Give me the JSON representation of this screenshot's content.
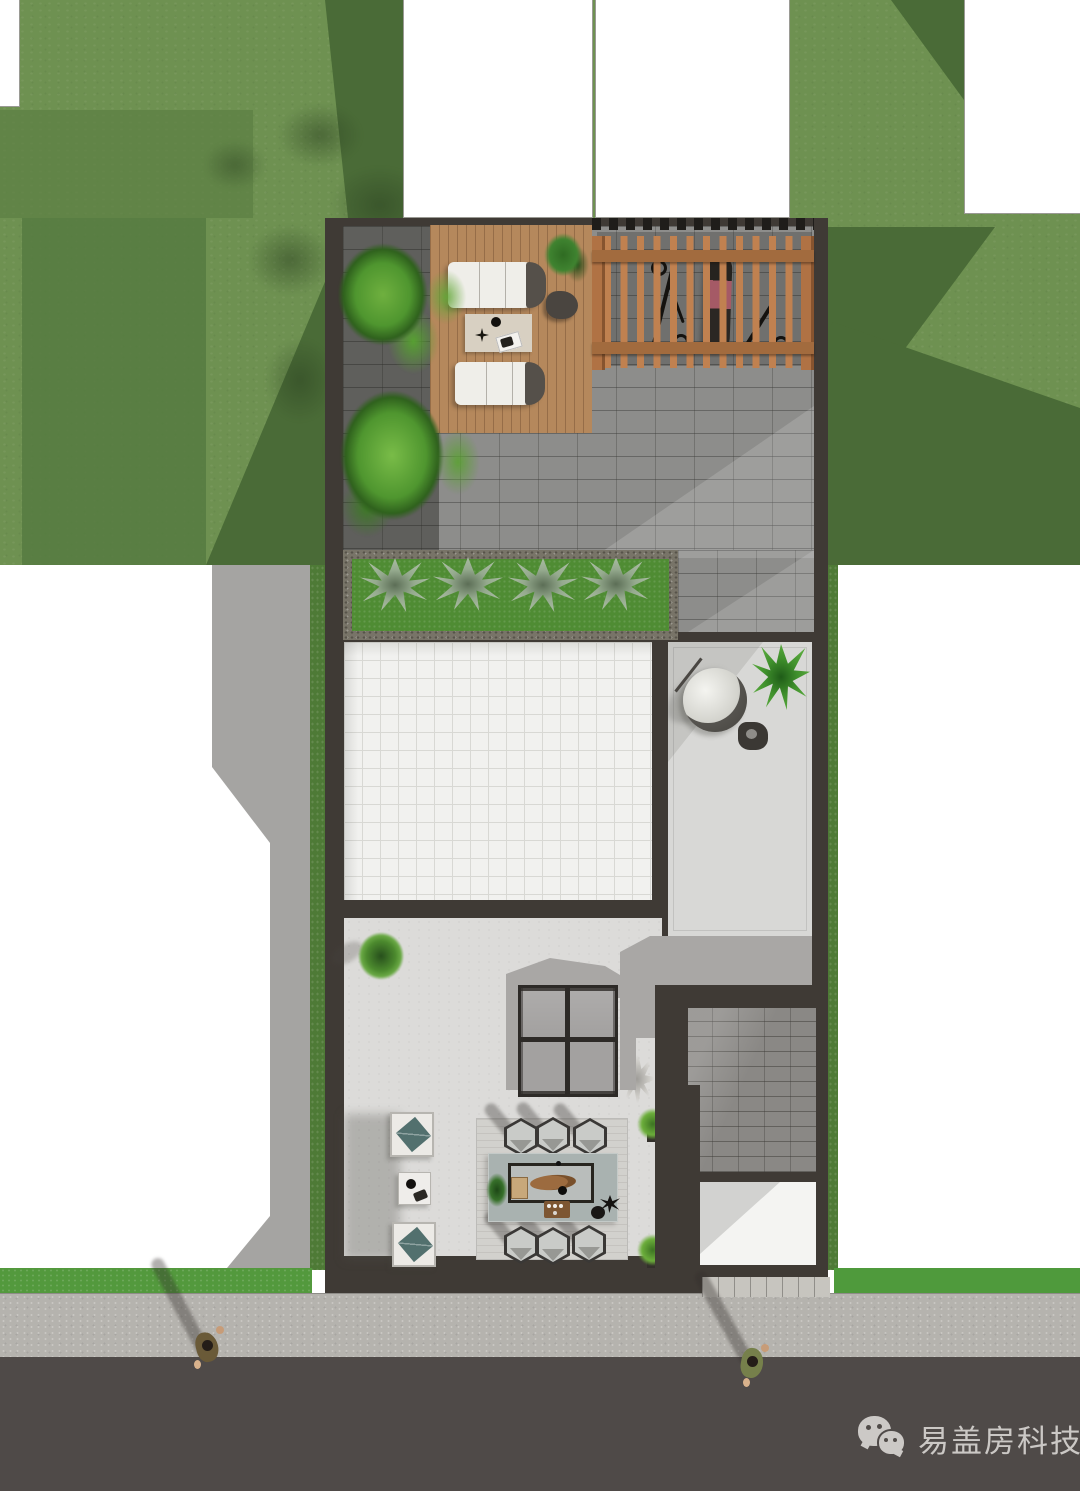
{
  "watermark": {
    "icon": "wechat-icon",
    "text": "易盖房科技"
  },
  "palette": {
    "lawn_light": "#6e9151",
    "lawn_medium": "#5d8044",
    "lawn_shadow": "#4a6b37",
    "lawn_bright_strip": "#53993d",
    "hedge_green": "#4e7a36",
    "wall_dark": "#3f3a35",
    "paving_gray": "#8d8d8b",
    "deck_wood": "#b5885c",
    "pergola_wood": "#c08150",
    "white_grid_tile": "#f1f1ef",
    "terrace_floor": "#d8d8d6",
    "courtyard_floor": "#dcdbd9",
    "shadow_gray": "#a9a7a5",
    "shingle_gray": "#8a8885",
    "sidewalk": "#b5b3ae",
    "road_asphalt": "#4f4a48",
    "neighbor_block_white": "#ffffff",
    "bed_grass": "#4f8c33",
    "agave_green": "#95aa8e",
    "tea_table_teal": "#a9b2b0",
    "rug_gray": "#d2d1cd",
    "wood_board": "#9c6b3f",
    "stool_gray": "#c9cbc8",
    "lounge_white": "#efeee9",
    "cushion_teal": "#52706e",
    "watermark_text_color": "#d6d3d0"
  }
}
